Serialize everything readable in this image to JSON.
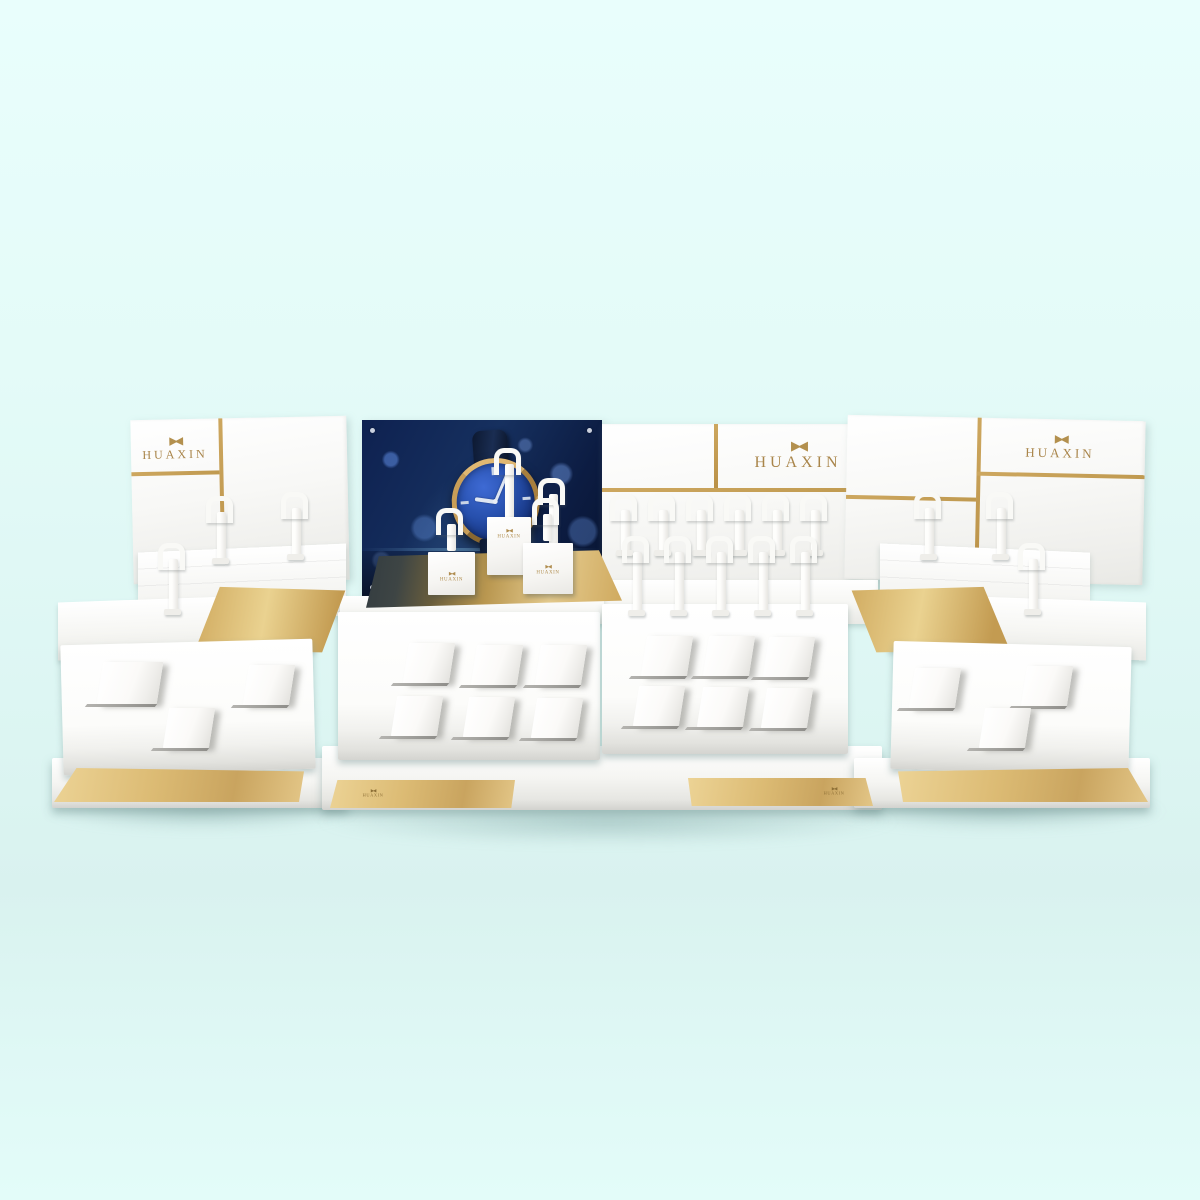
{
  "scene": {
    "description": "3D render of a three-piece white and gold HUAXIN watch retail counter display set on a pale mint background",
    "background_color": "#e3fbf8"
  },
  "brand": {
    "name": "HUAXIN",
    "logo_glyph": "▶◀",
    "logo_icon": "bowtie-butterfly-mark"
  },
  "colors": {
    "gold_line": "#c9a45f",
    "gold_light": "#ecd395",
    "gold_deep": "#b8944e",
    "panel_white": "#ffffff",
    "poster_navy": "#0e2150",
    "watch_dial_blue": "#2750ad",
    "watch_case_gold": "#c59c58",
    "watch_strap_navy": "#0c1830",
    "floor_mint": "#ddf6f3"
  },
  "units": {
    "left": {
      "panel_logo": "HUAXIN",
      "hook_stand_count": 3,
      "wedge_count": 3,
      "has_gold_plate": true
    },
    "center": {
      "panel_logo": "HUAXIN",
      "poster": {
        "subject": "blue-dial gold-case wristwatch on dark bokeh background"
      },
      "cube_logos": [
        "HUAXIN",
        "HUAXIN",
        "HUAXIN"
      ],
      "base_strip_logos": [
        "HUAXIN",
        "HUAXIN"
      ],
      "back_row_hook_count": 6,
      "front_row_hook_count": 5,
      "left_tray_wedge_count": 6,
      "right_tray_wedge_count": 6
    },
    "right": {
      "panel_logo": "HUAXIN",
      "hook_stand_count": 3,
      "wedge_count": 3,
      "has_gold_plate": true
    }
  }
}
